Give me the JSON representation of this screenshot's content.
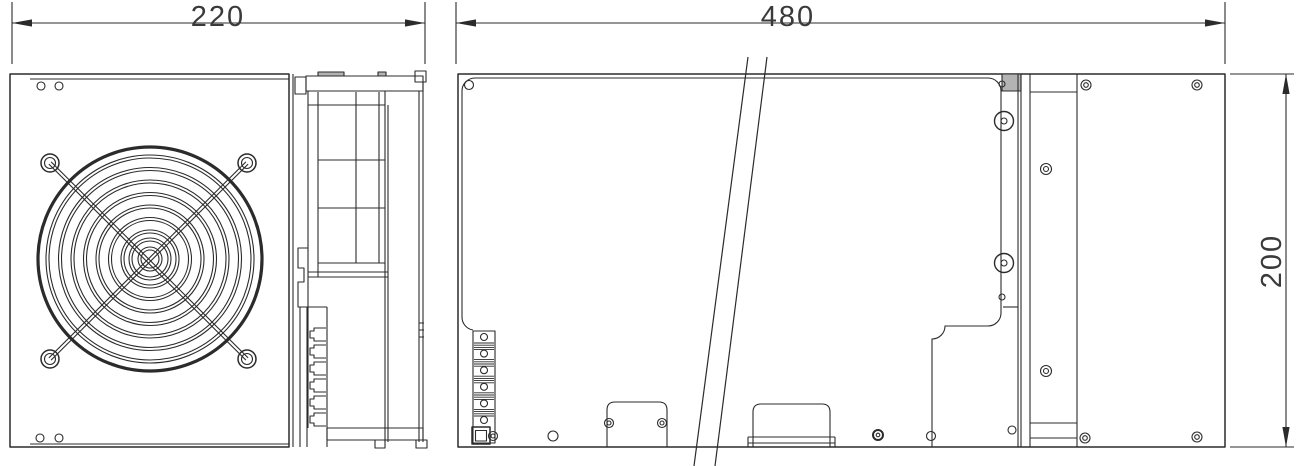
{
  "drawing": {
    "type": "technical-drawing-two-views",
    "dimensions": {
      "front_width": "220",
      "side_width": "480",
      "side_height": "200"
    },
    "views": {
      "front": "front-view-with-fan-guard",
      "side": "side-view-long-panel"
    },
    "colors": {
      "line": "#2b2b2b",
      "background": "#ffffff",
      "shade": "#b3b3b3"
    }
  }
}
